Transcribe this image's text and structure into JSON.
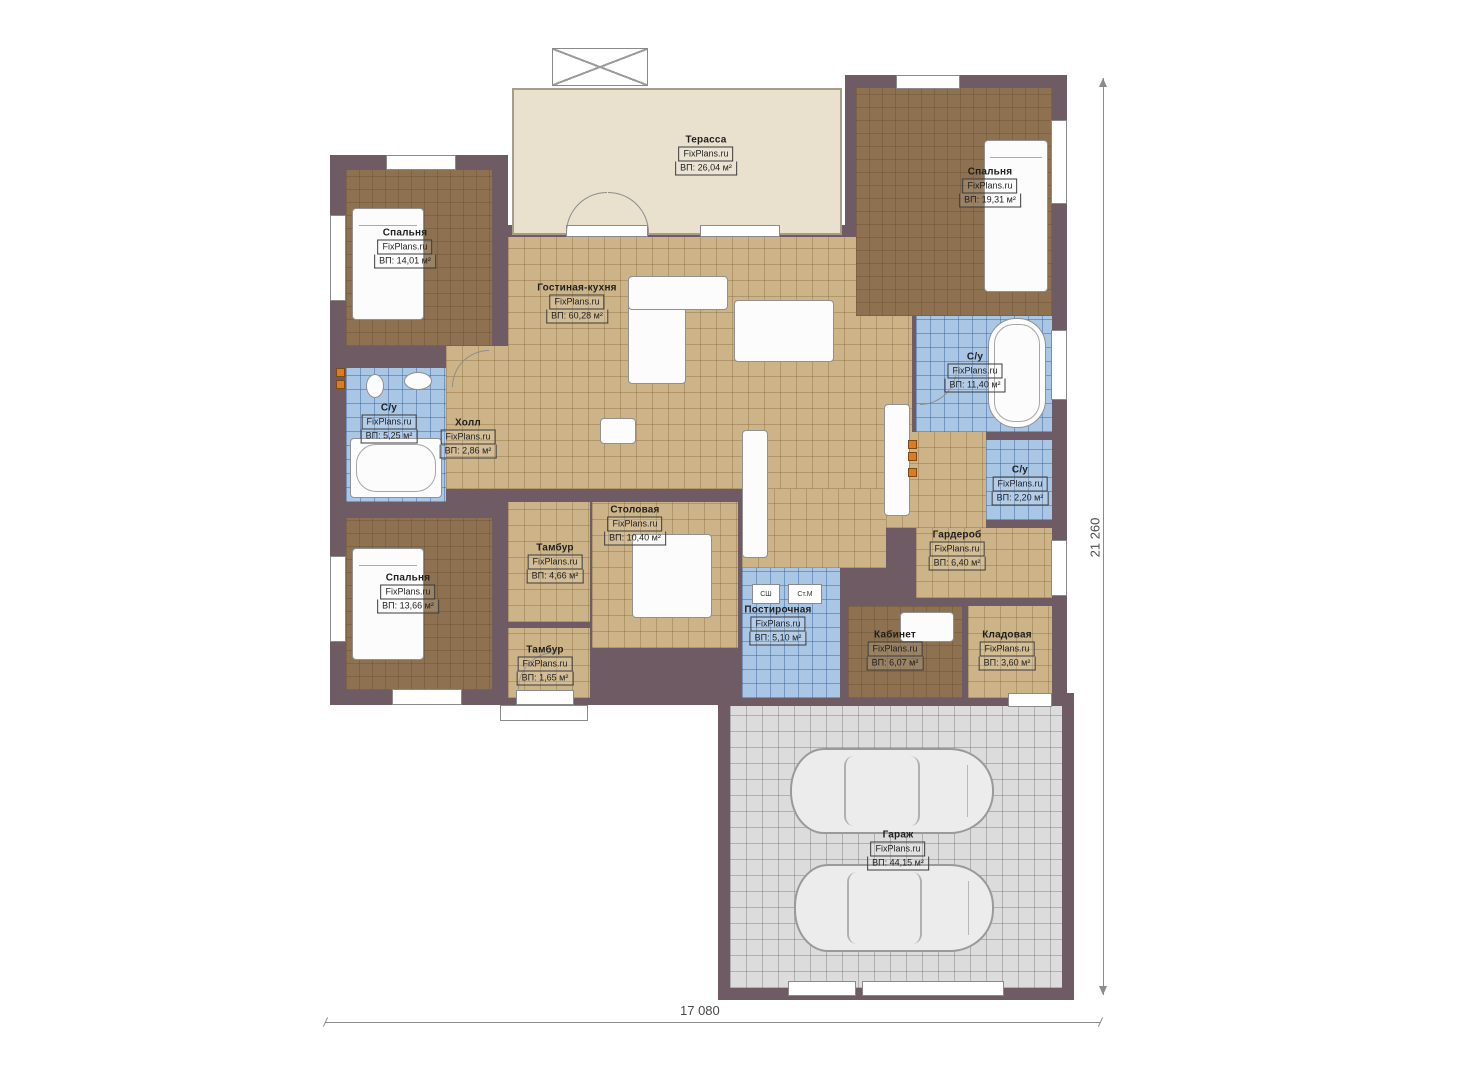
{
  "plan": {
    "brand": "FixPlans.ru",
    "rooms": [
      {
        "id": "terrace",
        "name": "Терасса",
        "area": "ВП: 26,04 м²"
      },
      {
        "id": "bedroom_tr",
        "name": "Спальня",
        "area": "ВП: 19,31 м²"
      },
      {
        "id": "bedroom_tl",
        "name": "Спальня",
        "area": "ВП: 14,01 м²"
      },
      {
        "id": "living",
        "name": "Гостиная-кухня",
        "area": "ВП: 60,28 м²"
      },
      {
        "id": "bath_l",
        "name": "С/у",
        "area": "ВП: 5,25 м²"
      },
      {
        "id": "hall",
        "name": "Холл",
        "area": "ВП: 2,86 м²"
      },
      {
        "id": "bath_r",
        "name": "С/у",
        "area": "ВП: 11,40 м²"
      },
      {
        "id": "wc_r",
        "name": "С/у",
        "area": "ВП: 2,20 м²"
      },
      {
        "id": "dining",
        "name": "Столовая",
        "area": "ВП: 10,40 м²"
      },
      {
        "id": "tambour1",
        "name": "Тамбур",
        "area": "ВП: 4,66 м²"
      },
      {
        "id": "bedroom_bl",
        "name": "Спальня",
        "area": "ВП: 13,66 м²"
      },
      {
        "id": "wardrobe",
        "name": "Гардероб",
        "area": "ВП: 6,40 м²"
      },
      {
        "id": "laundry",
        "name": "Постирочная",
        "area": "ВП: 5,10 м²"
      },
      {
        "id": "cabinet",
        "name": "Кабинет",
        "area": "ВП: 6,07 м²"
      },
      {
        "id": "storage",
        "name": "Кладовая",
        "area": "ВП: 3,60 м²"
      },
      {
        "id": "tambour2",
        "name": "Тамбур",
        "area": "ВП: 1,65 м²"
      },
      {
        "id": "garage",
        "name": "Гараж",
        "area": "ВП: 44,15 м²"
      }
    ],
    "appliances": {
      "dryer": "СШ",
      "washer": "Ст.М"
    },
    "dimensions": {
      "width": "17 080",
      "height": "21 260"
    },
    "colors": {
      "wall": "#6f5b63",
      "wood": "#8d7150",
      "tile": "#cdb488",
      "wet": "#a9c6e5",
      "terrace": "#e9e0cd",
      "garage": "#dcdcdc",
      "accent": "#e0791f"
    }
  }
}
